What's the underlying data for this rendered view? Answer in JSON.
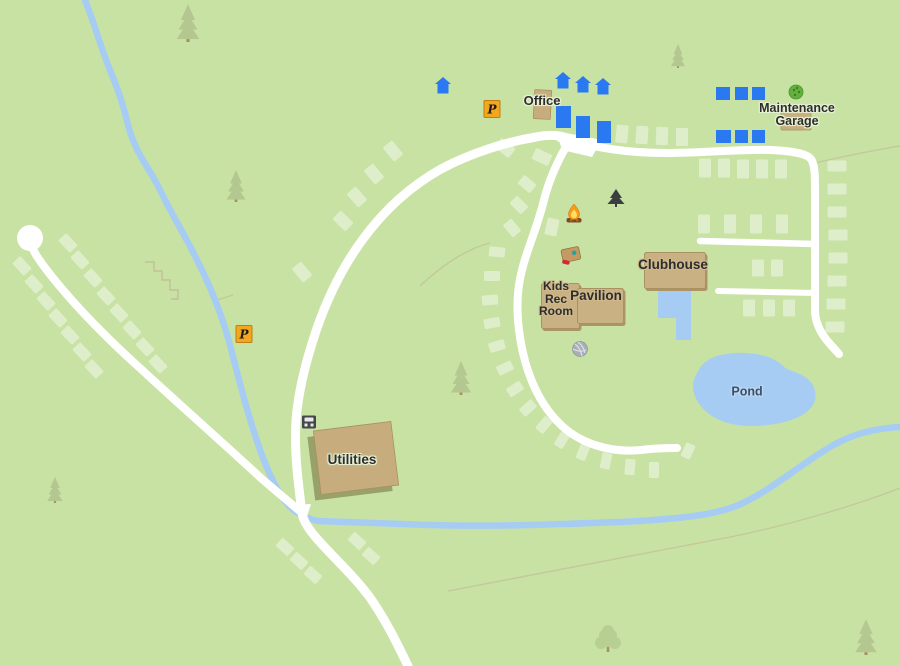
{
  "colors": {
    "background": "#c8e2a4",
    "road": "#ffffff",
    "water": "#a6ccf3",
    "campsite_pad": "#ffffff",
    "building_blue": "#2a79f0",
    "building_tan": "#c7ad7d",
    "building_tan_border": "#a8925f",
    "building_shadow": "#97a169",
    "label_box": "#c9b183",
    "label_box_edge": "#ad9468",
    "label_text": "#2d2d2d",
    "pond_label_text": "#3c4f68",
    "parking_yellow": "#f3a71f",
    "parking_border": "#c07f15",
    "tree_green": "#b3c58f",
    "tree_leaf": "#b7cd92",
    "tree_trunk": "#a18a58",
    "bush_green": "#62b13c",
    "icon_dark": "#43474c",
    "fire_orange": "#f59c1a",
    "grill_red": "#c6203a",
    "trail_tan": "#c2b795"
  },
  "glyphs": {
    "parking": "P"
  },
  "labels": [
    {
      "id": "office",
      "text": "Office",
      "cx": 542,
      "cy": 101,
      "fs": 13,
      "kind": "plain"
    },
    {
      "id": "maintenance-garage",
      "lines": [
        "Maintenance",
        "Garage"
      ],
      "cx": 797,
      "cy": 115,
      "fs": 12.5,
      "kind": "multiline"
    },
    {
      "id": "clubhouse",
      "text": "Clubhouse",
      "cx": 673,
      "cy": 265,
      "fs": 13.5,
      "kind": "box",
      "box": {
        "x": 644,
        "y": 252,
        "w": 60,
        "h": 35
      }
    },
    {
      "id": "kids-rec-room",
      "lines": [
        "Kids",
        "Rec",
        "Room"
      ],
      "cx": 556,
      "cy": 299,
      "fs": 12,
      "kind": "box",
      "box": {
        "x": 541,
        "y": 283,
        "w": 37,
        "h": 44
      }
    },
    {
      "id": "pavilion",
      "text": "Pavilion",
      "cx": 596,
      "cy": 296,
      "fs": 13.5,
      "kind": "box",
      "box": {
        "x": 577,
        "y": 288,
        "w": 45,
        "h": 34
      }
    },
    {
      "id": "pond",
      "text": "Pond",
      "cx": 747,
      "cy": 392,
      "fs": 12.5,
      "kind": "water"
    },
    {
      "id": "utilities",
      "text": "Utilities",
      "cx": 352,
      "cy": 460,
      "fs": 13.5,
      "kind": "plain"
    }
  ],
  "icons": [
    {
      "type": "parking",
      "name": "parking-icon",
      "x": 492,
      "y": 109
    },
    {
      "type": "parking",
      "name": "parking-icon",
      "x": 244,
      "y": 334
    },
    {
      "type": "bush",
      "name": "bush-icon",
      "x": 796,
      "y": 92
    },
    {
      "type": "tent",
      "name": "tent-icon",
      "x": 616,
      "y": 201
    },
    {
      "type": "campfire",
      "name": "campfire-icon",
      "x": 574,
      "y": 215
    },
    {
      "type": "picnic-table",
      "name": "picnic-table-icon",
      "x": 571,
      "y": 255
    },
    {
      "type": "grill",
      "name": "grill-icon",
      "x": 594,
      "y": 307
    },
    {
      "type": "ball",
      "name": "ball-icon",
      "x": 580,
      "y": 349
    },
    {
      "type": "games",
      "name": "games-icon",
      "x": 663,
      "y": 280
    },
    {
      "type": "restrooms",
      "name": "restrooms-icon",
      "x": 679,
      "y": 280
    },
    {
      "type": "meter",
      "name": "electric-meter-icon",
      "x": 309,
      "y": 422
    }
  ],
  "houses": [
    [
      443,
      85
    ],
    [
      563,
      80
    ],
    [
      583,
      84
    ],
    [
      603,
      86
    ]
  ],
  "buildings_blue": [
    [
      556,
      106,
      15,
      22
    ],
    [
      576,
      116,
      14,
      22
    ],
    [
      597,
      121,
      14,
      22
    ],
    [
      716,
      87,
      14,
      13
    ],
    [
      735,
      87,
      13,
      13
    ],
    [
      752,
      87,
      13,
      13
    ],
    [
      716,
      130,
      15,
      13
    ],
    [
      735,
      130,
      13,
      13
    ],
    [
      752,
      130,
      13,
      13
    ]
  ],
  "buildings_tan": [
    {
      "id": "office-building",
      "x": 534,
      "y": 90,
      "w": 17,
      "h": 29,
      "r": 3
    },
    {
      "id": "maintenance-building",
      "x": 781,
      "y": 106,
      "w": 30,
      "h": 24,
      "r": 0
    }
  ],
  "utilities_building": {
    "cx": 356,
    "cy": 458,
    "w": 78,
    "h": 64,
    "r": -7
  },
  "trees": [
    [
      "pine",
      188,
      42,
      0.95
    ],
    [
      "pine",
      236,
      202,
      0.8
    ],
    [
      "pine",
      678,
      68,
      0.6
    ],
    [
      "pine",
      461,
      395,
      0.85
    ],
    [
      "pine",
      55,
      503,
      0.65
    ],
    [
      "pine",
      866,
      655,
      0.9
    ],
    [
      "leaf",
      608,
      652,
      1
    ]
  ],
  "campsite_pads": [
    [
      22,
      266,
      17,
      11,
      47
    ],
    [
      34,
      284,
      17,
      11,
      47
    ],
    [
      46,
      301,
      17,
      11,
      47
    ],
    [
      58,
      318,
      17,
      11,
      47
    ],
    [
      70,
      335,
      17,
      11,
      47
    ],
    [
      82,
      352,
      17,
      11,
      47
    ],
    [
      94,
      369,
      17,
      11,
      47
    ],
    [
      68,
      243,
      17,
      11,
      47
    ],
    [
      80,
      260,
      17,
      11,
      47
    ],
    [
      93,
      278,
      17,
      11,
      47
    ],
    [
      106,
      296,
      17,
      11,
      47
    ],
    [
      119,
      313,
      17,
      11,
      47
    ],
    [
      132,
      330,
      17,
      11,
      47
    ],
    [
      145,
      347,
      17,
      11,
      47
    ],
    [
      158,
      364,
      17,
      11,
      47
    ],
    [
      285,
      547,
      16,
      11,
      42
    ],
    [
      299,
      561,
      16,
      11,
      42
    ],
    [
      313,
      575,
      16,
      11,
      42
    ],
    [
      357,
      541,
      16,
      11,
      42
    ],
    [
      371,
      556,
      16,
      11,
      42
    ],
    [
      393,
      151,
      18,
      12,
      50
    ],
    [
      374,
      174,
      18,
      12,
      50
    ],
    [
      357,
      197,
      18,
      12,
      48
    ],
    [
      343,
      221,
      18,
      12,
      45
    ],
    [
      302,
      272,
      18,
      12,
      50
    ],
    [
      505,
      148,
      18,
      12,
      38
    ],
    [
      542,
      157,
      18,
      12,
      25
    ],
    [
      527,
      184,
      16,
      11,
      40
    ],
    [
      519,
      205,
      16,
      11,
      45
    ],
    [
      512,
      228,
      16,
      11,
      50
    ],
    [
      497,
      252,
      16,
      10,
      5
    ],
    [
      492,
      276,
      16,
      10,
      0
    ],
    [
      490,
      300,
      16,
      10,
      -4
    ],
    [
      492,
      323,
      16,
      10,
      -10
    ],
    [
      497,
      346,
      16,
      10,
      -17
    ],
    [
      505,
      368,
      16,
      10,
      -25
    ],
    [
      515,
      389,
      16,
      10,
      -33
    ],
    [
      528,
      408,
      16,
      10,
      -42
    ],
    [
      544,
      425,
      16,
      10,
      -50
    ],
    [
      562,
      440,
      16,
      10,
      -58
    ],
    [
      583,
      452,
      16,
      10,
      -68
    ],
    [
      606,
      461,
      16,
      10,
      -78
    ],
    [
      630,
      467,
      16,
      10,
      -85
    ],
    [
      654,
      470,
      16,
      10,
      -89
    ],
    [
      688,
      451,
      15,
      10,
      -65
    ],
    [
      552,
      227,
      12,
      17,
      12
    ],
    [
      622,
      134,
      12,
      18,
      6
    ],
    [
      642,
      135,
      12,
      18,
      4
    ],
    [
      662,
      136,
      12,
      18,
      2
    ],
    [
      682,
      137,
      12,
      18,
      0
    ],
    [
      705,
      168,
      12,
      19,
      0
    ],
    [
      724,
      168,
      12,
      19,
      0
    ],
    [
      743,
      169,
      12,
      19,
      0
    ],
    [
      762,
      169,
      12,
      19,
      0
    ],
    [
      781,
      169,
      12,
      19,
      0
    ],
    [
      704,
      224,
      12,
      19,
      0
    ],
    [
      730,
      224,
      12,
      19,
      0
    ],
    [
      756,
      224,
      12,
      19,
      0
    ],
    [
      782,
      224,
      12,
      19,
      0
    ],
    [
      758,
      268,
      12,
      17,
      0
    ],
    [
      777,
      268,
      12,
      17,
      0
    ],
    [
      749,
      308,
      12,
      17,
      0
    ],
    [
      769,
      308,
      12,
      17,
      0
    ],
    [
      789,
      308,
      12,
      17,
      0
    ],
    [
      837,
      166,
      19,
      11,
      0
    ],
    [
      837,
      189,
      19,
      11,
      0
    ],
    [
      837,
      212,
      19,
      11,
      0
    ],
    [
      838,
      235,
      19,
      11,
      0
    ],
    [
      838,
      258,
      19,
      11,
      0
    ],
    [
      837,
      281,
      19,
      11,
      0
    ],
    [
      836,
      304,
      19,
      11,
      0
    ],
    [
      835,
      327,
      19,
      11,
      0
    ]
  ]
}
